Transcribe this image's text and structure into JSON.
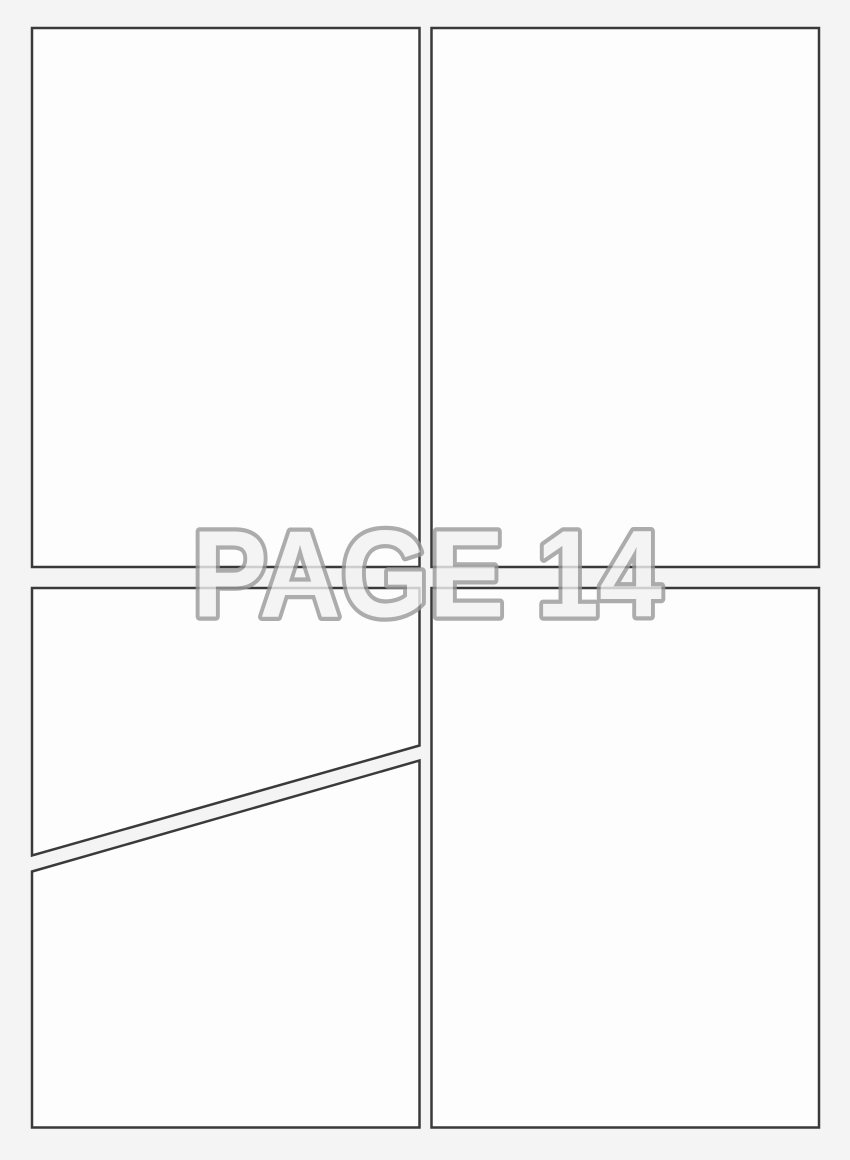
{
  "page": {
    "label": "PAGE 14"
  },
  "colors": {
    "background": "#f4f4f4",
    "panel_fill": "#fdfdfd",
    "panel_border": "#3a3a3a",
    "label_fill": "#f2f2f2",
    "label_outline": "#999999"
  }
}
